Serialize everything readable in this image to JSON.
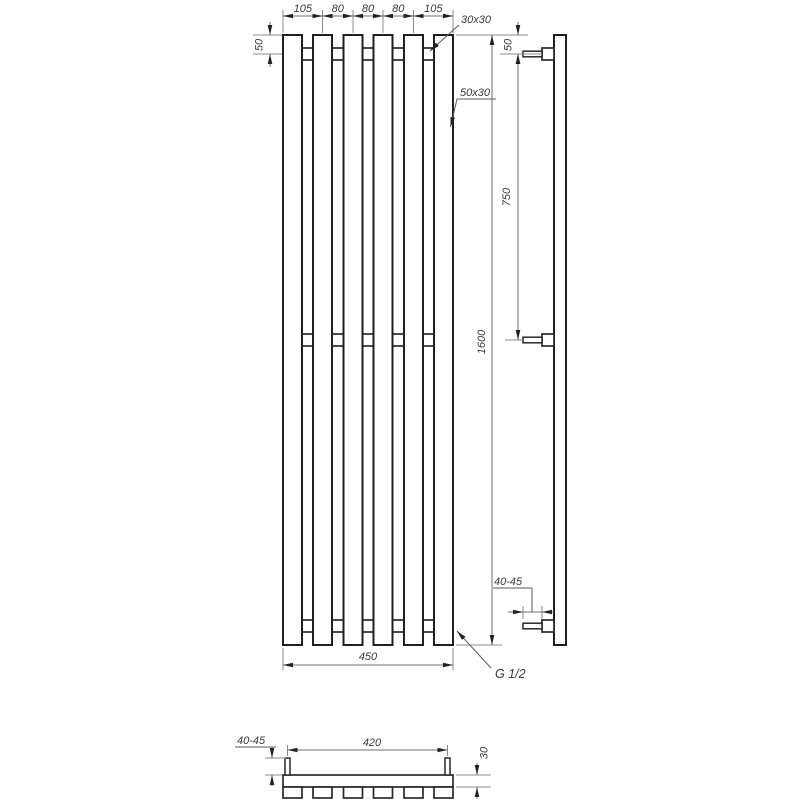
{
  "drawing": {
    "type": "technical-drawing-towel-radiator",
    "views": {
      "front": {
        "top_dims": [
          "105",
          "80",
          "80",
          "80",
          "105"
        ],
        "collector_offset_dim": "50",
        "collector_profile_label": "30x30",
        "bar_profile_label": "50x30",
        "height_dim": "1600",
        "width_dim": "450",
        "connection_thread_label": "G 1/2"
      },
      "side": {
        "top_connection_offset_dim": "50",
        "connection_spacing_dim": "750",
        "pipe_protrusion_dim": "40-45"
      },
      "top": {
        "pipe_protrusion_dim": "40-45",
        "connection_spacing_dim": "420",
        "collector_depth_dim": "30"
      }
    },
    "colors": {
      "background": "#ffffff",
      "object_line": "#1f1f1f",
      "dimension_line": "#8c8c8c",
      "arrow": "#222222",
      "text": "#3a3a3a"
    }
  }
}
